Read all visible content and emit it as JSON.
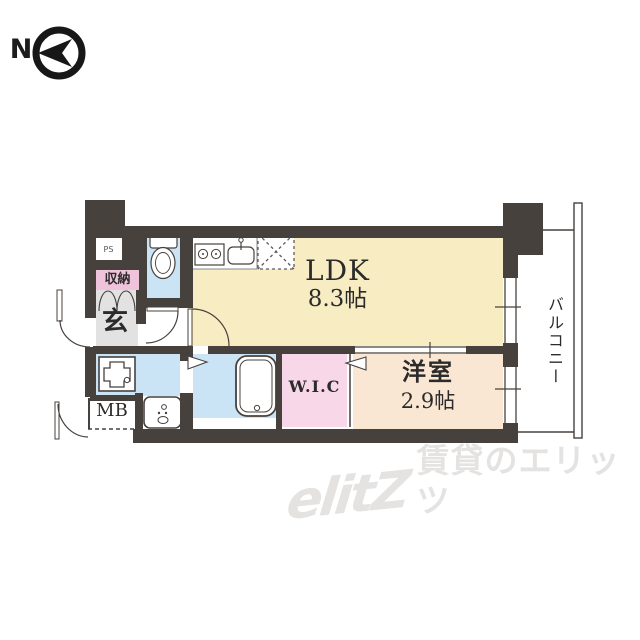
{
  "compass": {
    "label": "N"
  },
  "floor_plan": {
    "rooms": {
      "ldk": {
        "name": "LDK",
        "size": "8.3帖",
        "color": "#F8ECC3"
      },
      "western_room": {
        "name": "洋室",
        "size": "2.9帖",
        "color": "#F9E6D3"
      },
      "wic": {
        "name": "W.I.C",
        "color": "#F8D7E9"
      },
      "balcony": {
        "name": "バルコニー"
      },
      "entrance": {
        "name": "玄",
        "floor_color": "#E2E2E2"
      },
      "storage": {
        "name": "収納",
        "color": "#EFC3DA"
      },
      "meter_box": {
        "name": "MB"
      },
      "pipe_space": {
        "name": "PS"
      }
    },
    "colors": {
      "wall": "#47413E",
      "wet_area": "#CBE4F5",
      "line": "#4a4442"
    },
    "fixtures": [
      "toilet",
      "kitchen-stove",
      "kitchen-sink",
      "refrigerator-space",
      "washing-machine-pan",
      "bathtub",
      "vanity-sink"
    ]
  },
  "watermark": {
    "logo": "elitZ",
    "text": "賃貸のエリッツ",
    "color": "#E5E3E1"
  }
}
